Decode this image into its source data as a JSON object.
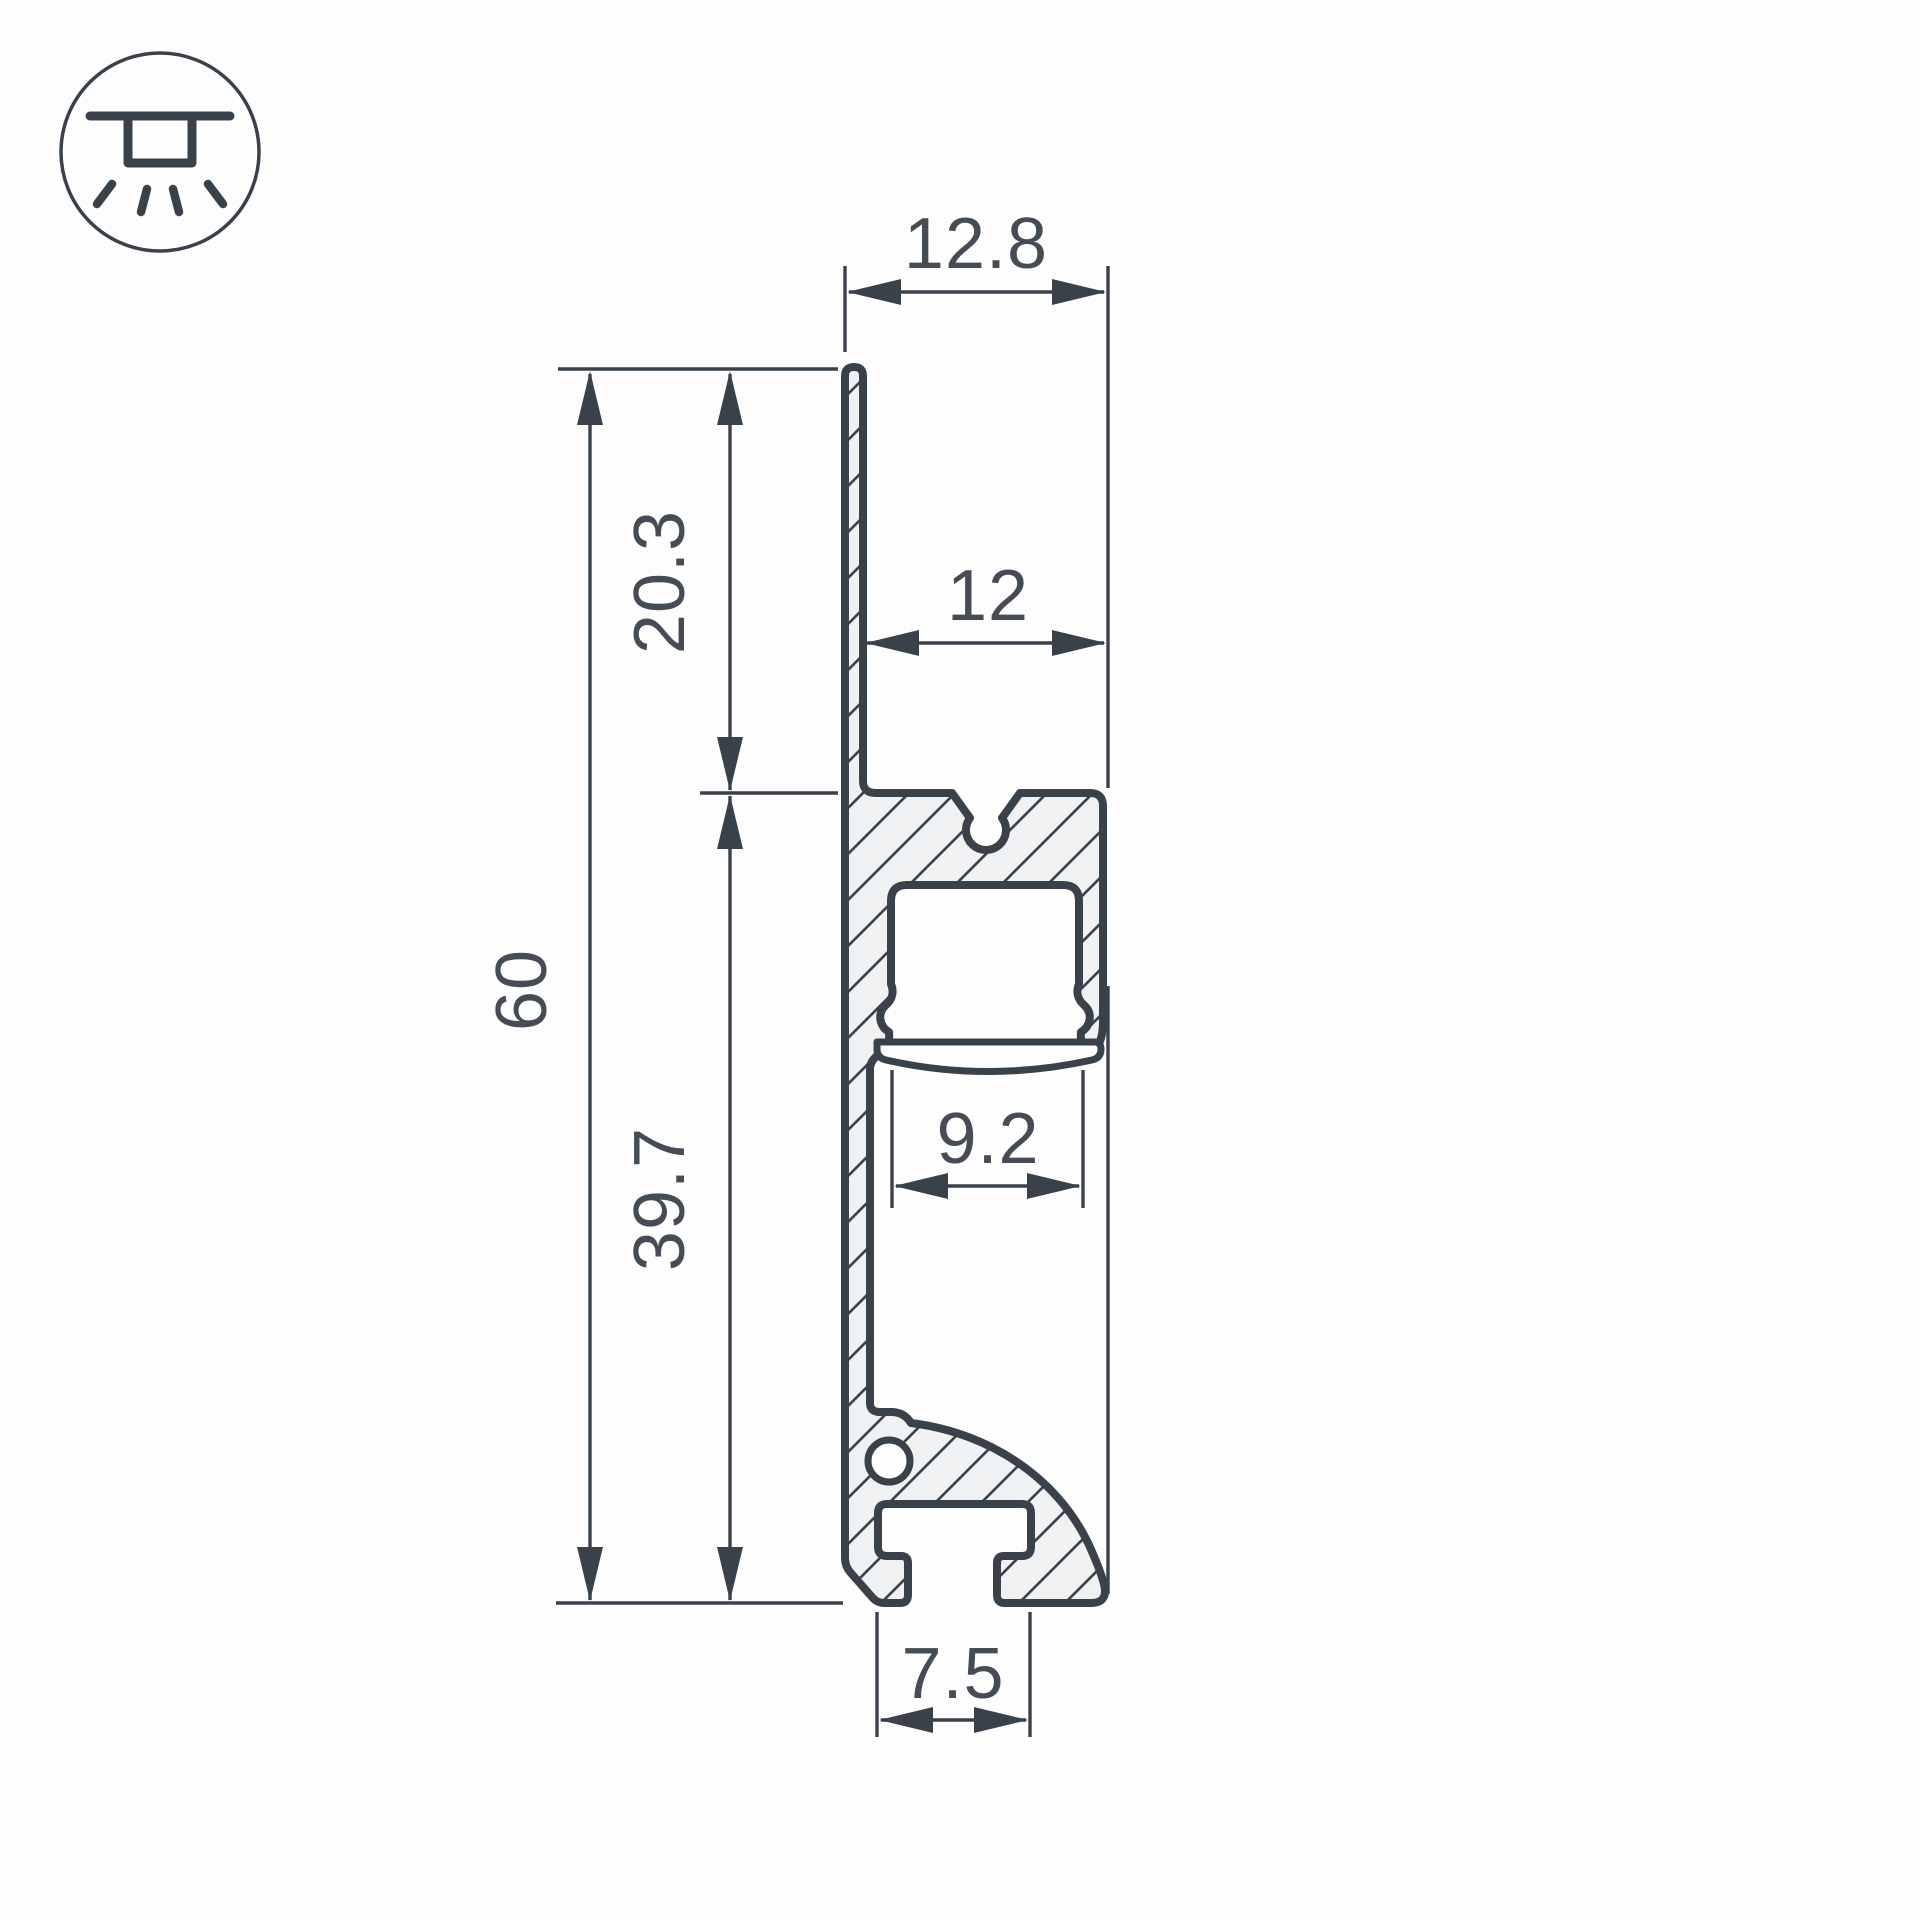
{
  "drawing": {
    "type": "led-profile-cross-section",
    "icon": {
      "name": "recessed-ceiling-light-icon"
    },
    "dimensions": {
      "overall_depth_top": "12.8",
      "upper_height": "20.3",
      "channel_depth": "12",
      "overall_height": "60",
      "lower_height": "39.7",
      "opening_width": "9.2",
      "slot_width": "7.5"
    },
    "colors": {
      "line": "#39424b",
      "text": "#454c55",
      "hatch_fill": "#eff1f3",
      "background": "#fdfdfd"
    }
  }
}
